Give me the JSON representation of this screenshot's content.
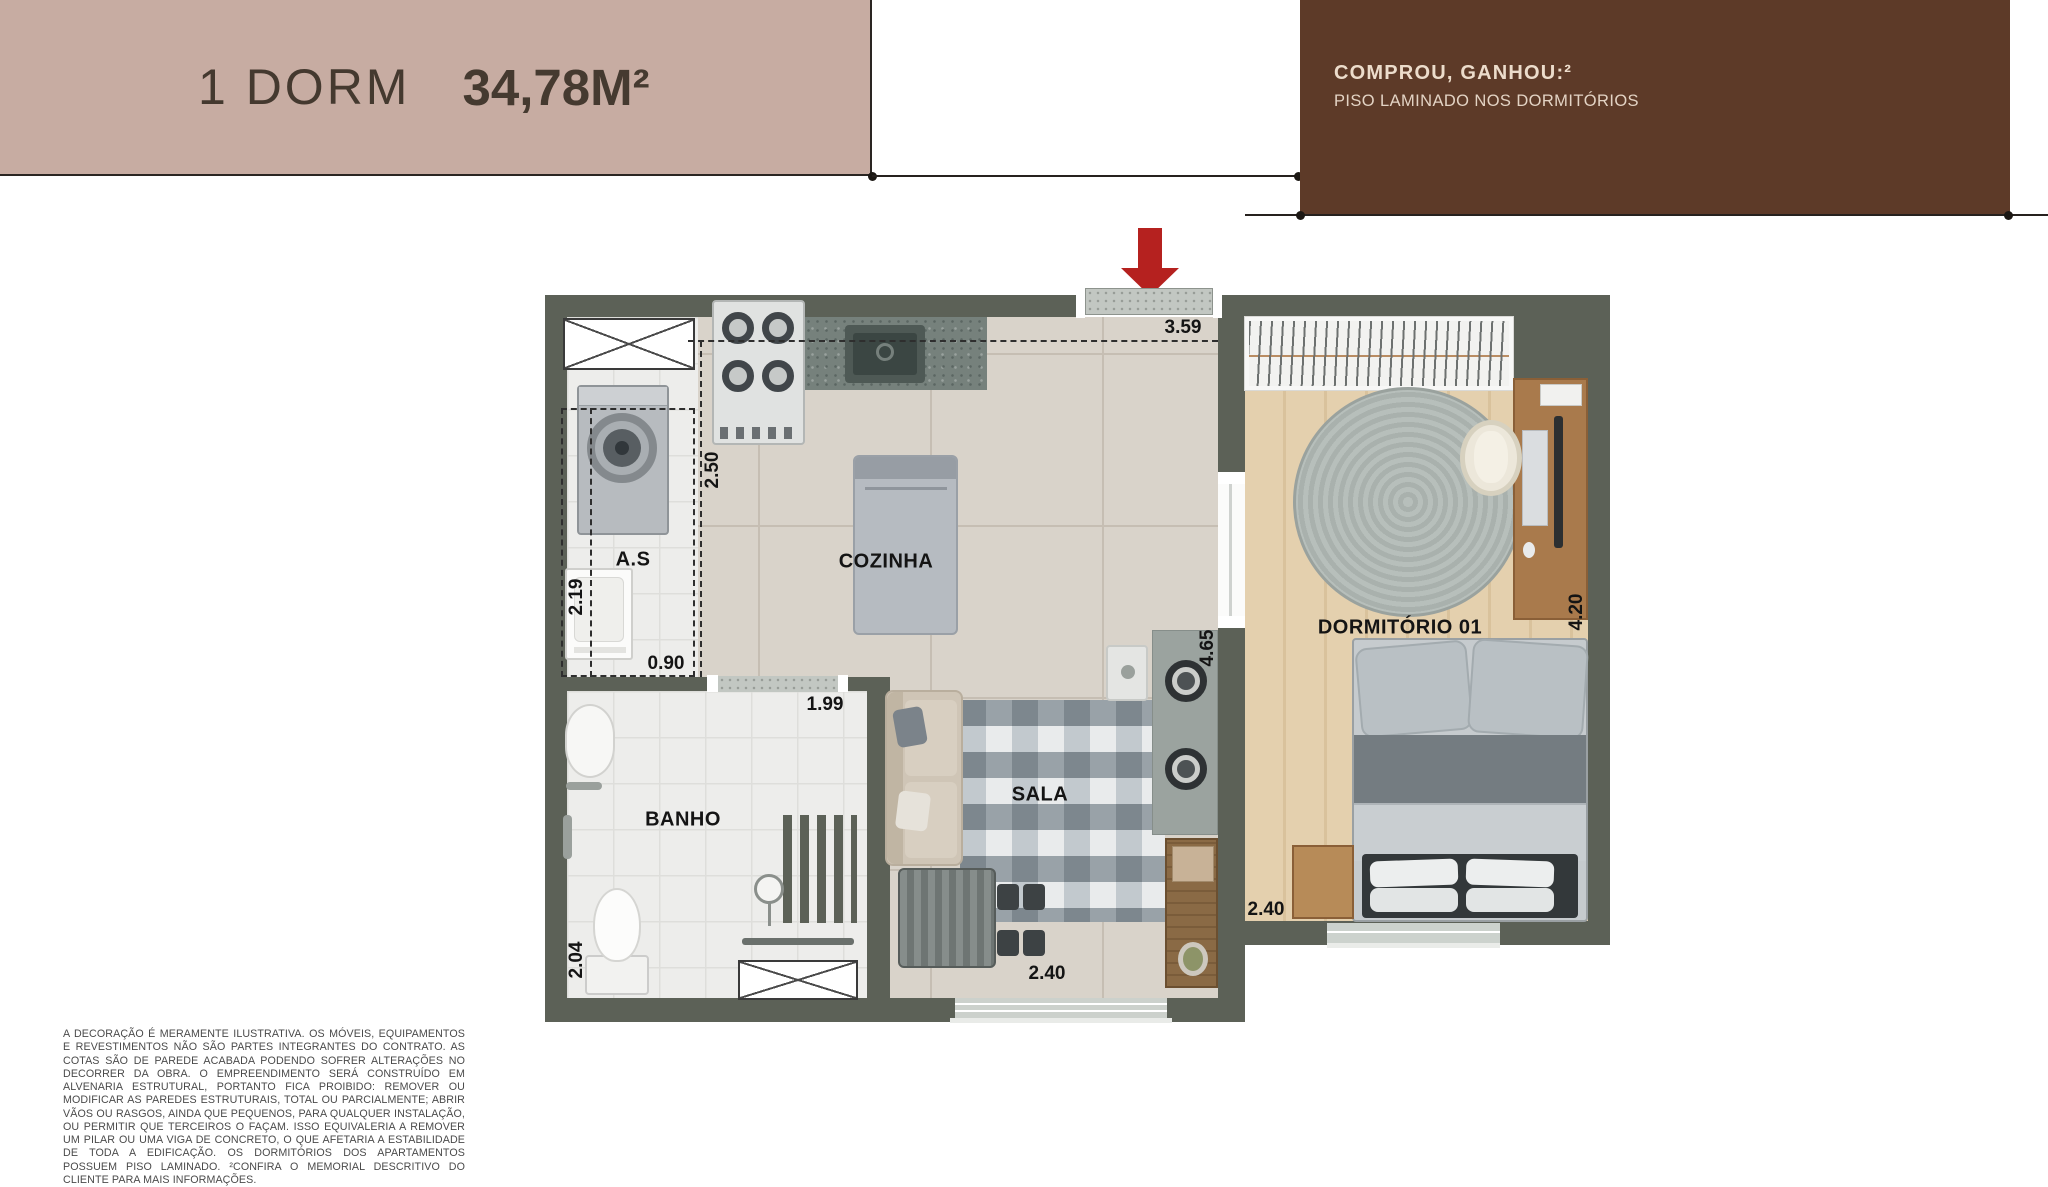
{
  "header": {
    "title": "1 DORM",
    "area": "34,78M²"
  },
  "promo": {
    "title": "COMPROU, GANHOU:²",
    "subtitle": "PISO LAMINADO NOS DORMITÓRIOS"
  },
  "plan": {
    "rooms": {
      "kitchen": "COZINHA",
      "service": "A.S",
      "bath": "BANHO",
      "living": "SALA",
      "bedroom": "DORMITÓRIO 01"
    },
    "dimensions": {
      "kitchen_width": "3.59",
      "kitchen_depth": "2.50",
      "service_depth": "2.19",
      "service_width": "0.90",
      "bath_width": "1.99",
      "bath_depth": "2.04",
      "living_length": "4.65",
      "living_window": "2.40",
      "bedroom_width": "2.40",
      "bedroom_length": "4.20"
    },
    "icons": {
      "entrance_arrow": "entrance-arrow-icon",
      "shaft": "ventilation-shaft-icon",
      "bath_window": "bath-window-icon"
    },
    "colors": {
      "wall": "#5c6157",
      "accent_red": "#b5211f",
      "header_beige": "#c7aca2",
      "promo_brown": "#5d3a28",
      "wood_floor": "#ddc7a3",
      "tile_floor": "#d9d3ca"
    }
  },
  "disclaimer": {
    "text": "A DECORAÇÃO É MERAMENTE ILUSTRATIVA. OS MÓVEIS, EQUIPAMENTOS E REVESTIMENTOS NÃO SÃO PARTES INTEGRANTES DO CONTRATO. AS COTAS SÃO DE PAREDE ACABADA PODENDO SOFRER ALTERAÇÕES NO DECORRER DA OBRA. O EMPREENDIMENTO SERÁ CONSTRUÍDO EM ALVENARIA ESTRUTURAL, PORTANTO FICA PROIBIDO: REMOVER OU MODIFICAR AS PAREDES ESTRUTURAIS, TOTAL OU PARCIALMENTE; ABRIR VÃOS OU RASGOS, AINDA QUE PEQUENOS, PARA QUALQUER INSTALAÇÃO, OU PERMITIR QUE TERCEIROS O FAÇAM. ISSO EQUIVALERIA A REMOVER UM PILAR OU UMA VIGA DE CONCRETO, O QUE AFETARIA A ESTABILIDADE DE TODA A EDIFICAÇÃO. OS DORMITÓRIOS DOS APARTAMENTOS POSSUEM PISO LAMINADO. ²CONFIRA O MEMORIAL DESCRITIVO DO CLIENTE PARA MAIS INFORMAÇÕES."
  }
}
